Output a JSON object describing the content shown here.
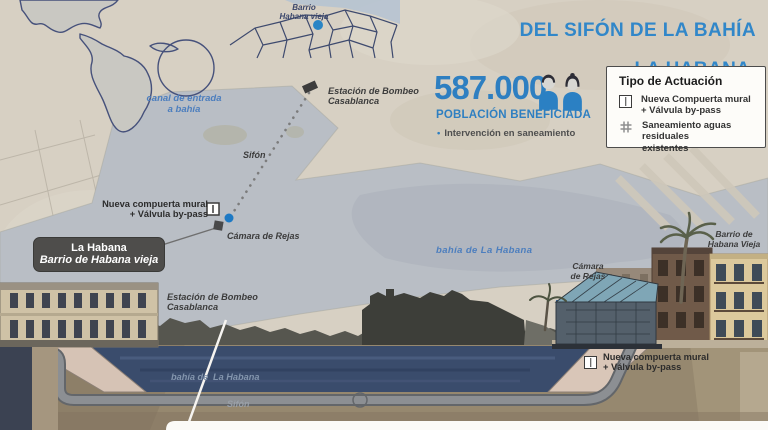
{
  "header": {
    "title_line1": "DEL SIFÓN DE LA BAHÍA",
    "title_line2": "LA HABANA.",
    "project_code": "CUB003B"
  },
  "inset_map": {
    "label": "Barrio\nHabana vieja"
  },
  "stats": {
    "value": "587.000",
    "caption": "POBLACIÓN BENEFICIADA",
    "bullet": "•",
    "note": "Intervención en saneamiento"
  },
  "legend": {
    "title": "Tipo de Actuación",
    "items": [
      {
        "icon": "sluice-gate-icon",
        "label": "Nueva Compuerta mural\n+ Válvula by-pass"
      },
      {
        "icon": "hash-grid-icon",
        "label": "Saneamiento aguas residuales\nexistentes"
      }
    ]
  },
  "map": {
    "canal": "canal de entrada\na bahía",
    "pumping_station": "Estación de Bombeo\nCasablanca",
    "siphon": "Sifón",
    "new_gate": "Nueva compuerta mural\n+ Válvula by-pass",
    "screens_chamber": "Cámara de Rejas",
    "bay": "bahía de La Habana",
    "screens_chamber_2": "Cámara\nde Rejas",
    "old_town": "Barrio de\nHabana Vieja",
    "city_box": {
      "city": "La Habana",
      "district": "Barrio de Habana vieja"
    }
  },
  "cross_section": {
    "pumping_station": "Estación de Bombeo\nCasablanca",
    "bay_part1": "bahía de",
    "bay_part2": "La Habana",
    "siphon": "Sifón",
    "new_gate": "Nueva compuerta mural\n+ Válvula by-pass"
  },
  "colors": {
    "accent_blue": "#2e7fc1",
    "label_blue": "#4c7ebe",
    "dark_label": "#3c3c3c",
    "map_water": "#b9bec5",
    "section_water": "#3a4c6c",
    "ground": "#96886f"
  }
}
